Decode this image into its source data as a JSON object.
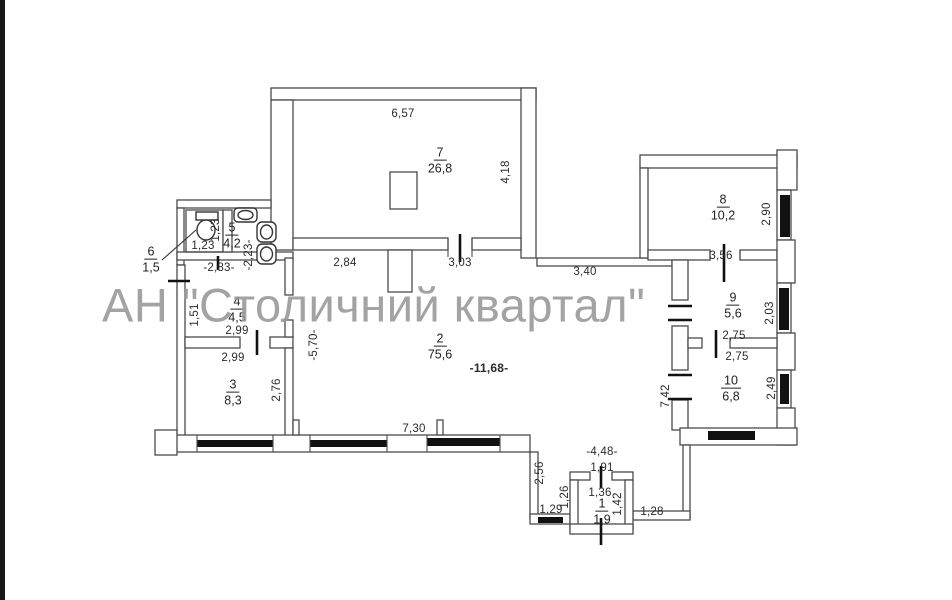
{
  "watermark": {
    "text": "АН \"Столичний квартал\"",
    "color": "#969696"
  },
  "colors": {
    "wall_line": "#4a4a4a",
    "window_fill": "#111111",
    "background": "#ffffff"
  },
  "icons": {
    "toilet": "toilet-icon",
    "sink": "sink-icon",
    "basin": "basin-icon"
  },
  "rooms": {
    "r1": {
      "number": "1",
      "area": "1,9"
    },
    "r2": {
      "number": "2",
      "area": "75,6"
    },
    "r3": {
      "number": "3",
      "area": "8,3"
    },
    "r4": {
      "number": "4",
      "area": "4,5"
    },
    "r5": {
      "number": "5",
      "area": "4,2"
    },
    "r6": {
      "number": "6",
      "area": "1,5"
    },
    "r7": {
      "number": "7",
      "area": "26,8"
    },
    "r8": {
      "number": "8",
      "area": "10,2"
    },
    "r9": {
      "number": "9",
      "area": "5,6"
    },
    "r10": {
      "number": "10",
      "area": "6,8"
    }
  },
  "dims": {
    "d657": "6,57",
    "d418": "4,18",
    "d284": "2,84",
    "d303": "3,03",
    "d340": "3,40",
    "d1168": "-11,68-",
    "d570": "-5,70-",
    "d730": "7,30",
    "d123h": "1,23",
    "d123v": "1,23",
    "d283": "-2,83-",
    "d223": "-2,23-",
    "d151": "1,51",
    "d299a": "2,99",
    "d299b": "2,99",
    "d276": "2,76",
    "d290": "2,90",
    "d356": "3,56",
    "d203": "2,03",
    "d275a": "2,75",
    "d275b": "2,75",
    "d742": "7,42",
    "d249": "2,49",
    "d448": "-4,48-",
    "d191": "1,91",
    "d136": "1,36",
    "d142": "1,42",
    "d126": "1,26",
    "d129": "1,29",
    "d128": "1,28",
    "d256": "2,56"
  }
}
